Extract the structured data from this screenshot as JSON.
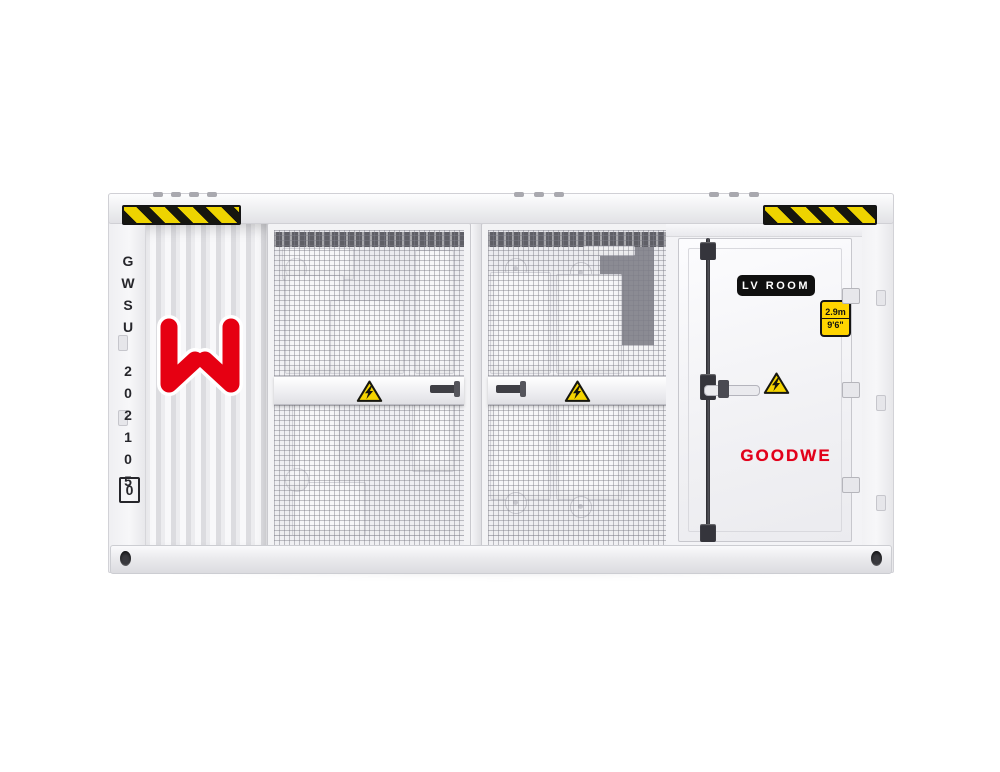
{
  "unit": {
    "code": {
      "serial": "GWSU 202105",
      "check_digit": "0"
    },
    "brand_wordmark": "GOODWE",
    "door_plate_label": "LV ROOM",
    "height_badge": {
      "metric": "2.9m",
      "imperial": "9'6\""
    },
    "colors": {
      "brand_red": "#e2001a",
      "logo_red": "#e60012",
      "hazard_yellow": "#eed400",
      "hazard_black": "#141414",
      "body_white": "#f4f4f6",
      "plate_black": "#101010",
      "badge_yellow": "#ffd400"
    },
    "icons": {
      "logo": "goodwe-w-mark",
      "warning": "high-voltage-triangle-icon",
      "stripe": "black-yellow-hazard-stripe"
    }
  }
}
